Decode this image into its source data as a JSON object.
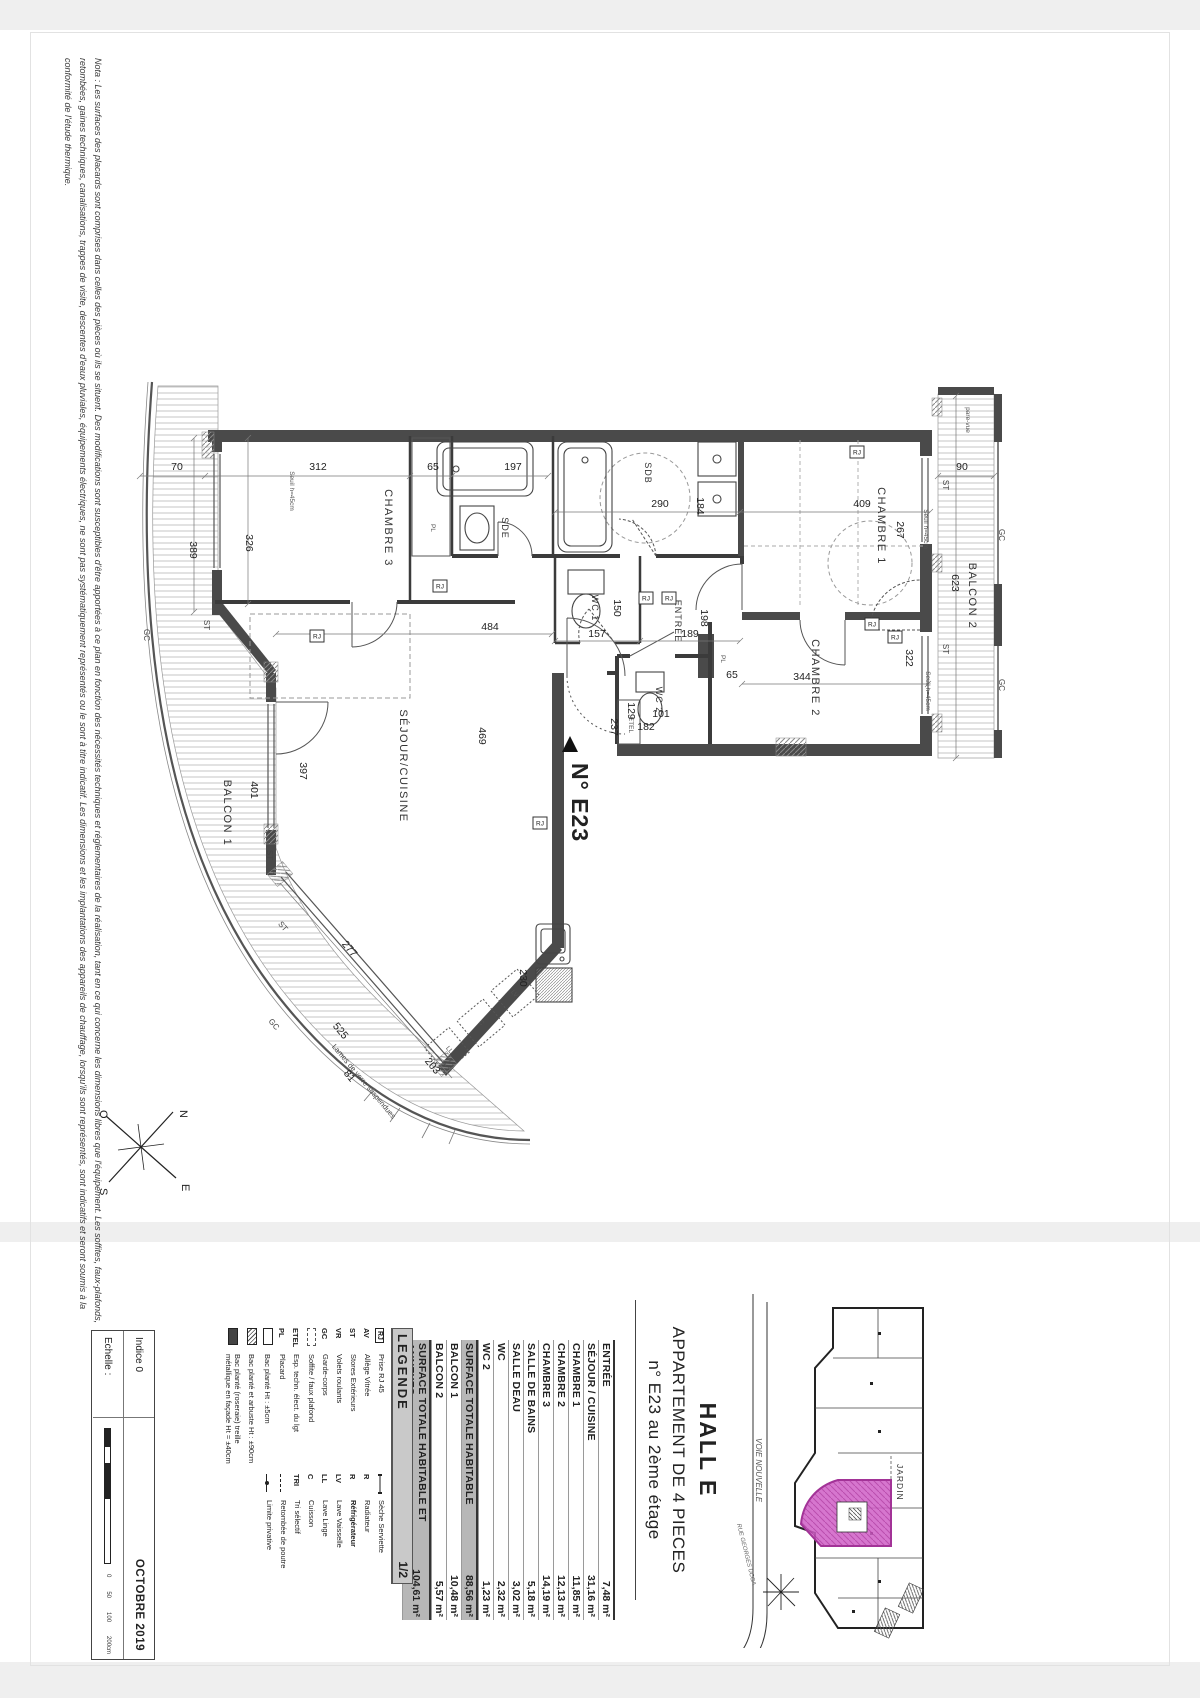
{
  "note": {
    "line1": "Nota : Les surfaces des placards sont comprises dans celles des pièces où ils se situent. Des modifications sont susceptibles d'être apportées à ce plan en fonction des nécessités techniques et réglementaires de la réalisation, tant en ce qui concerne les dimensions libres que l'équipement. Les soffites, faux-plafonds,",
    "line2": "retombées, gaines techniques, canalisations, trappes de visite, descentes d'eaux pluviales, équipements électriques, ne sont pas systématiquement représentés ou le sont à titre indicatif. Les dimensions et les implantations des appareils de chauffage, lorsqu'ils sont représentés, sont indicatifs et seront soumis à la",
    "line3": "conformité de l'étude thermique."
  },
  "plan": {
    "unit_label": "N° E23",
    "rj_label": "RJ",
    "rj": [
      [
        340,
        208
      ],
      [
        217,
        258
      ],
      [
        546,
        220
      ],
      [
        569,
        220
      ],
      [
        440,
        445
      ],
      [
        757,
        74
      ],
      [
        772,
        246
      ],
      [
        795,
        259
      ]
    ],
    "dims": [
      {
        "t": "70",
        "x": 77,
        "y": 92
      },
      {
        "t": "312",
        "x": 218,
        "y": 92
      },
      {
        "t": "65",
        "x": 333,
        "y": 92
      },
      {
        "t": "197",
        "x": 413,
        "y": 92
      },
      {
        "t": "290",
        "x": 560,
        "y": 129
      },
      {
        "t": "409",
        "x": 762,
        "y": 129
      },
      {
        "t": "90",
        "x": 862,
        "y": 92
      },
      {
        "t": "389",
        "x": 90,
        "y": 172,
        "r": 90
      },
      {
        "t": "326",
        "x": 146,
        "y": 165,
        "r": 90
      },
      {
        "t": "184",
        "x": 597,
        "y": 128,
        "r": 90
      },
      {
        "t": "267",
        "x": 797,
        "y": 152,
        "r": 90
      },
      {
        "t": "623",
        "x": 852,
        "y": 205,
        "r": 90
      },
      {
        "t": "157",
        "x": 497,
        "y": 259
      },
      {
        "t": "150",
        "x": 514,
        "y": 230,
        "r": 90
      },
      {
        "t": "189",
        "x": 590,
        "y": 259
      },
      {
        "t": "198",
        "x": 601,
        "y": 240,
        "r": 90
      },
      {
        "t": "237",
        "x": 511,
        "y": 349,
        "r": 90
      },
      {
        "t": "182",
        "x": 546,
        "y": 352
      },
      {
        "t": "129",
        "x": 528,
        "y": 333,
        "r": 90
      },
      {
        "t": "101",
        "x": 561,
        "y": 339
      },
      {
        "t": "65",
        "x": 632,
        "y": 300
      },
      {
        "t": "344",
        "x": 702,
        "y": 302
      },
      {
        "t": "322",
        "x": 806,
        "y": 280,
        "r": 90
      },
      {
        "t": "484",
        "x": 390,
        "y": 252
      },
      {
        "t": "469",
        "x": 379,
        "y": 358,
        "r": 90
      },
      {
        "t": "397",
        "x": 200,
        "y": 393,
        "r": 90
      },
      {
        "t": "401",
        "x": 151,
        "y": 412,
        "r": 90
      },
      {
        "t": "230",
        "x": 420,
        "y": 600,
        "r": 90
      },
      {
        "t": "277",
        "x": 247,
        "y": 573,
        "r": 50
      },
      {
        "t": "525",
        "x": 238,
        "y": 655,
        "r": 50
      },
      {
        "t": "81",
        "x": 247,
        "y": 700,
        "r": 50
      },
      {
        "t": "203",
        "x": 330,
        "y": 690,
        "r": 50
      }
    ],
    "labels": [
      {
        "t": "CHAMBRE 3",
        "x": 285,
        "y": 150,
        "r": 90,
        "c": "room"
      },
      {
        "t": "SDE",
        "x": 402,
        "y": 150,
        "r": 90,
        "c": "room-s"
      },
      {
        "t": "SDB",
        "x": 545,
        "y": 95,
        "r": 90,
        "c": "room-s"
      },
      {
        "t": "CHAMBRE 1",
        "x": 778,
        "y": 148,
        "r": 90,
        "c": "room"
      },
      {
        "t": "CHAMBRE 2",
        "x": 712,
        "y": 300,
        "r": 90,
        "c": "room"
      },
      {
        "t": "WC 1",
        "x": 492,
        "y": 230,
        "r": 90,
        "c": "room-s"
      },
      {
        "t": "WC 2",
        "x": 556,
        "y": 322,
        "r": 90,
        "c": "room-s"
      },
      {
        "t": "ENTRÉE",
        "x": 575,
        "y": 243,
        "r": 90,
        "c": "room-s"
      },
      {
        "t": "SÉJOUR/CUISINE",
        "x": 300,
        "y": 388,
        "r": 90,
        "c": "room"
      },
      {
        "t": "BALCON 1",
        "x": 124,
        "y": 435,
        "r": 90,
        "c": "room"
      },
      {
        "t": "BALCON 2",
        "x": 869,
        "y": 218,
        "r": 90,
        "c": "room"
      },
      {
        "t": "PL",
        "x": 331,
        "y": 150,
        "r": 90,
        "c": "tiny"
      },
      {
        "t": "PL",
        "x": 621,
        "y": 281,
        "r": 90,
        "c": "tiny"
      },
      {
        "t": "ETEL",
        "x": 529,
        "y": 347,
        "r": 90,
        "c": "tiny"
      },
      {
        "t": "ST",
        "x": 104,
        "y": 247,
        "r": 90,
        "c": "sm"
      },
      {
        "t": "ST",
        "x": 167,
        "y": 477,
        "r": 90,
        "c": "sm"
      },
      {
        "t": "ST",
        "x": 843,
        "y": 107,
        "r": 90,
        "c": "sm"
      },
      {
        "t": "ST",
        "x": 843,
        "y": 271,
        "r": 90,
        "c": "sm"
      },
      {
        "t": "ST",
        "x": 181,
        "y": 550,
        "r": 50,
        "c": "sm"
      },
      {
        "t": "GC",
        "x": 44,
        "y": 257,
        "r": 90,
        "c": "sm"
      },
      {
        "t": "GC",
        "x": 172,
        "y": 648,
        "r": 50,
        "c": "sm"
      },
      {
        "t": "GC",
        "x": 899,
        "y": 157,
        "r": 90,
        "c": "sm"
      },
      {
        "t": "GC",
        "x": 899,
        "y": 307,
        "r": 90,
        "c": "sm"
      },
      {
        "t": "pare-vue",
        "x": 866,
        "y": 42,
        "r": 90,
        "c": "tiny"
      },
      {
        "t": "Seuil h=45cm",
        "x": 190,
        "y": 113,
        "r": 90,
        "c": "tiny"
      },
      {
        "t": "Seuil h=45cm",
        "x": 824,
        "y": 151,
        "r": 90,
        "c": "tiny"
      },
      {
        "t": "Seuil h=45cm",
        "x": 826,
        "y": 313,
        "r": 90,
        "c": "tiny"
      },
      {
        "t": "Lames de verre suspendues",
        "x": 262,
        "y": 705,
        "r": 50,
        "c": "lames"
      },
      {
        "t": "LV",
        "x": 413,
        "y": 617,
        "r": 50,
        "c": "tiny"
      },
      {
        "t": "C",
        "x": 380,
        "y": 646,
        "r": 50,
        "c": "tiny"
      },
      {
        "t": "LL",
        "x": 348,
        "y": 673,
        "r": 50,
        "c": "tiny"
      }
    ]
  },
  "compass": {
    "n": "N",
    "s": "S",
    "e": "E",
    "o": "O"
  },
  "titleblock": {
    "map": {
      "road": "VOIE NOUVELLE",
      "garden": "JARDIN",
      "street": "RUE GEORGES UCCA"
    },
    "hall": "HALL E",
    "apartment_type": "APPARTEMENT DE 4 PIECES",
    "unit_line": "n° E23 au 2ème étage",
    "areas": [
      {
        "name": "ENTRÉE",
        "value": "7,48 m²"
      },
      {
        "name": "SÉJOUR / CUISINE",
        "value": "31,16 m²"
      },
      {
        "name": "CHAMBRE 1",
        "value": "11,85 m²"
      },
      {
        "name": "CHAMBRE 2",
        "value": "12,13 m²"
      },
      {
        "name": "CHAMBRE 3",
        "value": "14,19 m²"
      },
      {
        "name": "SALLE DE BAINS",
        "value": "5,18 m²"
      },
      {
        "name": "SALLE DEAU",
        "value": "3,02 m²"
      },
      {
        "name": "WC",
        "value": "2,32 m²"
      },
      {
        "name": "WC 2",
        "value": "1,23 m²"
      },
      {
        "name": "SURFACE TOTALE HABITABLE",
        "value": "88,56 m²",
        "total": true
      },
      {
        "name": "BALCON 1",
        "value": "10,48 m²"
      },
      {
        "name": "BALCON 2",
        "value": "5,57 m²"
      },
      {
        "name": "SURFACE TOTALE HABITABLE ET ANNEXES",
        "value": "104,61 m²",
        "total": true
      }
    ],
    "legend": {
      "title": "LEGENDE",
      "page": "1/2",
      "left": [
        {
          "sym": "box",
          "abbr": "RJ",
          "label": "Prise RJ 45"
        },
        {
          "sym": "ab",
          "abbr": "AV",
          "label": "Allège Vitrée"
        },
        {
          "sym": "ab",
          "abbr": "ST",
          "label": "Stores Extérieurs"
        },
        {
          "sym": "ab",
          "abbr": "VR",
          "label": "Volets roulants"
        },
        {
          "sym": "ab",
          "abbr": "GC",
          "label": "Garde-corps"
        },
        {
          "sym": "dashbox",
          "abbr": "",
          "label": "Soffite / faux plafond"
        },
        {
          "sym": "ab",
          "abbr": "ETEL",
          "label": "Esp. techn. élect. du lgt"
        },
        {
          "sym": "ab",
          "abbr": "PL",
          "label": "Placard"
        },
        {
          "sym": "bac1",
          "abbr": "",
          "label": "Bac planté Ht : ±5cm"
        },
        {
          "sym": "bac2",
          "abbr": "",
          "label": "Bac planté et arbuste Ht : ±90cm"
        },
        {
          "sym": "bac3",
          "abbr": "",
          "label": "Bac planté (roseraie) treille métallique en façade Ht = ±40cm"
        }
      ],
      "right": [
        {
          "sym": "ss",
          "abbr": "",
          "label": "Sèche Serviette"
        },
        {
          "sym": "ab",
          "abbr": "R",
          "label": "Radiateur"
        },
        {
          "sym": "ab",
          "abbr": "R",
          "label": "Réfrigérateur",
          "bold": true
        },
        {
          "sym": "ab",
          "abbr": "LV",
          "label": "Lave Vaisselle"
        },
        {
          "sym": "ab",
          "abbr": "LL",
          "label": "Lave Linge"
        },
        {
          "sym": "ab",
          "abbr": "C",
          "label": "Cuisson"
        },
        {
          "sym": "ab",
          "abbr": "TRI",
          "label": "Tri sélectif"
        },
        {
          "sym": "dash3",
          "abbr": "",
          "label": "Retombée de poutre"
        },
        {
          "sym": "lim",
          "abbr": "",
          "label": "Limite privative"
        }
      ]
    },
    "footer": {
      "indice": "Indice 0",
      "echelle": "Echelle :",
      "date": "OCTOBRE 2019",
      "scale_ticks": [
        "0",
        "50",
        "100",
        "200cm"
      ]
    }
  },
  "colors": {
    "wall": "#4a4a4a",
    "unit_highlight": "#cf5ec6"
  }
}
